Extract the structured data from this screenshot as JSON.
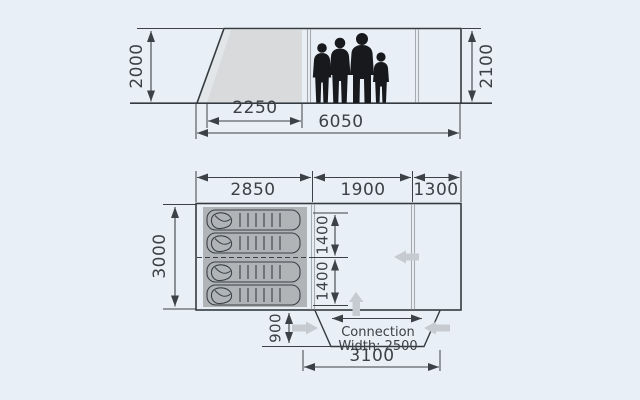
{
  "diagram_title": "Tent dimensions diagram (side elevation and floor plan)",
  "elevation": {
    "height_left": "2000",
    "height_right": "2100",
    "door_width": "2250",
    "total_length": "6050"
  },
  "floorplan": {
    "sleeping_width": "2850",
    "living_width": "1900",
    "canopy_width": "1300",
    "depth": "3000",
    "berth_upper": "1400",
    "berth_lower": "1400",
    "tunnel_depth": "900",
    "connection_line1": "Connection",
    "connection_line2": "Width: 2500",
    "tunnel_width": "3100"
  },
  "icons": {
    "sleeping_bag": "sleeping-bag-icon",
    "family": "family-silhouette-icon",
    "direction_arrows": "gray direction arrows (left, up, right)"
  },
  "colors": {
    "background": "#e9eff6",
    "line": "#3b4146",
    "silhouette": "#17191c",
    "sleeping_area": "#b1b4b6",
    "sleeping_bag": "#c8cacc",
    "door_panel": "#d8dadc",
    "door_wedge": "#e3e6e9",
    "direction_arrow": "#c6cbd1"
  }
}
